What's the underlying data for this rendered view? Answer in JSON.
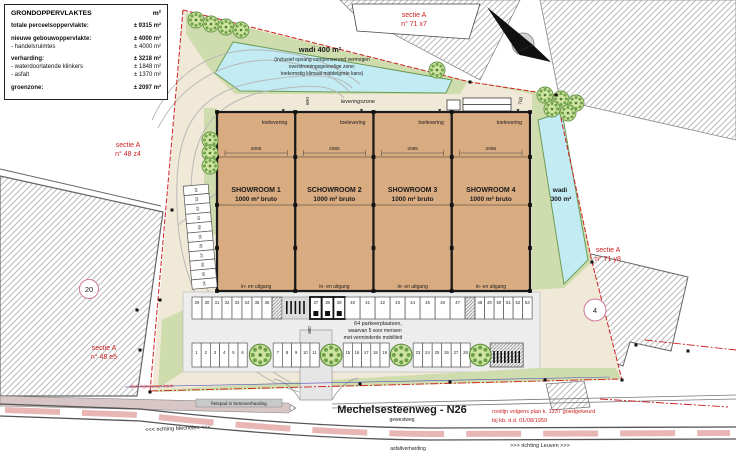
{
  "legend": {
    "title": "GRONDOPPERVLAKTES",
    "unit": "m²",
    "rows": [
      {
        "label": "totale perceelsoppervlakte:",
        "value": "± 9315 m²",
        "bold": true
      },
      {
        "label": "nieuwe gebouwoppervlakte:",
        "value": "± 4000 m²",
        "bold": true
      },
      {
        "label": "- handelsruimtes",
        "value": "± 4000 m²",
        "bold": false
      },
      {
        "label": "verharding:",
        "value": "± 3218 m²",
        "bold": true
      },
      {
        "label": "- waterdoorlatende klinkers",
        "value": "± 1848 m²",
        "bold": false
      },
      {
        "label": "- asfalt",
        "value": "± 1370 m²",
        "bold": false
      },
      {
        "label": "groenzone:",
        "value": "± 2097 m²",
        "bold": true
      }
    ]
  },
  "sections": {
    "ne": {
      "line1": "sectie A",
      "line2": "n° 71 x7"
    },
    "w": {
      "line1": "sectie A",
      "line2": "n° 48 z4"
    },
    "sw": {
      "line1": "sectie A",
      "line2": "n° 48 e5"
    },
    "e": {
      "line1": "sectie A",
      "line2": "n° 71 y8"
    }
  },
  "wadi400": {
    "title": "wadi 400 m²",
    "lines": [
      "(inclusief opvang compenserend vermogen",
      "overstromingsgevoelige zone:",
      "toekomstig klimaat middelgrote kans)"
    ]
  },
  "wadi300": {
    "line1": "wadi",
    "line2": "300 m²"
  },
  "leveringszone": "leveringszone",
  "showrooms": [
    {
      "name": "SHOWROOM 1",
      "area": "1000 m² bruto",
      "top": "toelevering",
      "width": "2085",
      "entrance": "in- en uitgang"
    },
    {
      "name": "SCHOWROOM 2",
      "area": "1000 m² bruto",
      "top": "toelevering",
      "width": "2085",
      "entrance": "in- en uitgang"
    },
    {
      "name": "SHOWROOM 3",
      "area": "1000 m² bruto",
      "top": "toelevering",
      "width": "2085",
      "entrance": "in- en uitgang"
    },
    {
      "name": "SHOWROOM 4",
      "area": "1000 m² bruto",
      "top": "toelevering",
      "width": "2085",
      "entrance": "in- en uitgang"
    }
  ],
  "dims": {
    "top": "800",
    "right": "700",
    "depth": "4800",
    "gap": "110",
    "aisle1": "600",
    "aisle2": "800",
    "stall": "500"
  },
  "parking": {
    "note": [
      "64 parkeerplaatsen,",
      "waarvan 5 voor mensen",
      "met verminderde mobiliteit"
    ],
    "upper": [
      "29",
      "30",
      "31",
      "32",
      "33",
      "34",
      "35",
      "36",
      "37",
      "38",
      "39",
      "40",
      "41",
      "42",
      "43",
      "44",
      "45",
      "46",
      "47",
      "48",
      "49",
      "50",
      "51",
      "52",
      "53"
    ],
    "lower": [
      "1",
      "2",
      "3",
      "4",
      "5",
      "6",
      "7",
      "8",
      "9",
      "10",
      "11",
      "15",
      "16",
      "17",
      "18",
      "19",
      "23",
      "24",
      "25",
      "26",
      "27",
      "28"
    ],
    "side": [
      "64",
      "63",
      "62",
      "61",
      "60",
      "59",
      "58",
      "57",
      "56",
      "55",
      "54"
    ]
  },
  "parcels": {
    "p20": "20",
    "p4": "4"
  },
  "road": {
    "name": "Mechelsesteenweg - N26",
    "type": "gewestweg",
    "surface": "asfaltverharding",
    "left": "<<< richting Mechelen <<<",
    "right": ">>> richting Leuven >>>",
    "cycle": "fietspad in betonverharding",
    "note": "deel ingenomen berm",
    "rooilijn": [
      "rooilijn volgens plan k. 1237 goedgekeurd",
      "bij kb. d.d. 01/08/1959"
    ]
  }
}
